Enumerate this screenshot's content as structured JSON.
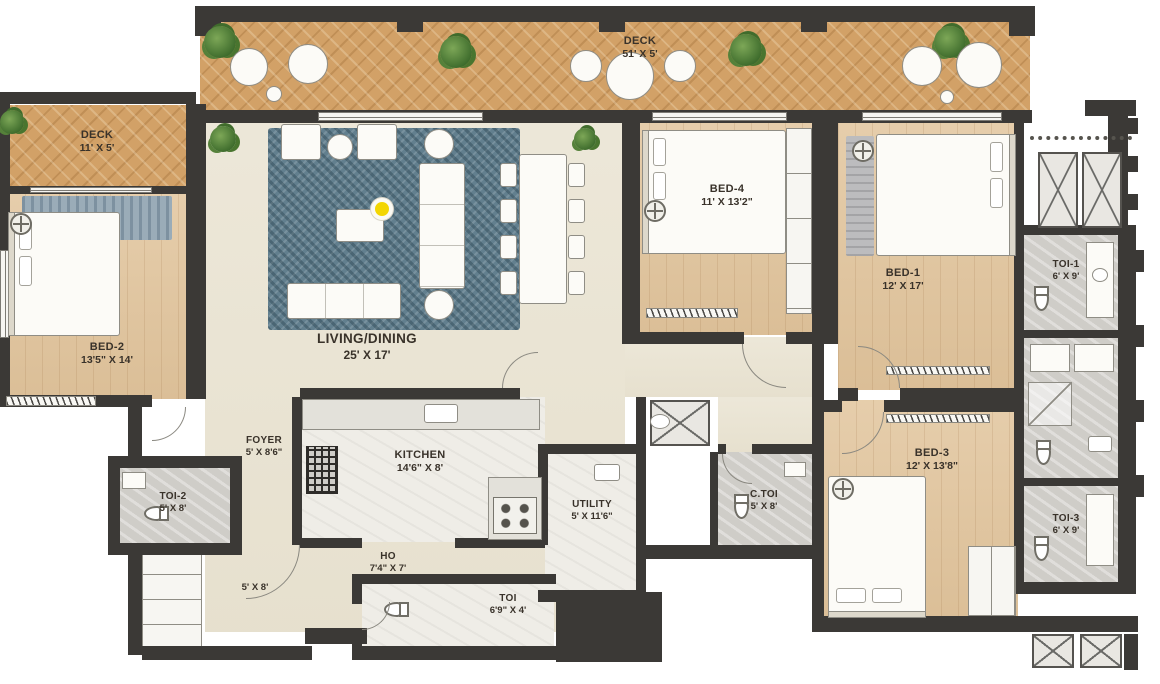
{
  "meta": {
    "type": "apartment-floor-plan"
  },
  "colors": {
    "wall": "#3b3936",
    "deck_wood": "#d2a167",
    "bedroom_wood": "#e3c8a2",
    "living_floor": "#eae4d3",
    "toilet_gray": "#cfcdc8",
    "rug_blue": "#627f8e",
    "accent_yellow": "#f3d602",
    "plant_green": "#49752f"
  },
  "icons": {
    "ceiling_fan": "circle-with-cross",
    "plant": "green-foliage-blob",
    "wc": "toilet-pan-with-cistern",
    "lamp": "yellow-dot-white-ring",
    "duct": "x-hatched-shaft",
    "door": "quarter-circle-swing-arc"
  },
  "rooms": {
    "deck_main": {
      "name": "DECK",
      "dims": "51' X 5'"
    },
    "deck_left": {
      "name": "DECK",
      "dims": "11' X 5'"
    },
    "bed2": {
      "name": "BED-2",
      "dims": "13'5\" X 14'"
    },
    "living": {
      "name": "LIVING/DINING",
      "dims": "25' X 17'"
    },
    "bed4": {
      "name": "BED-4",
      "dims": "11' X 13'2\""
    },
    "bed1": {
      "name": "BED-1",
      "dims": "12' X 17'"
    },
    "toi1": {
      "name": "TOI-1",
      "dims": "6' X 9'"
    },
    "foyer": {
      "name": "FOYER",
      "dims": "5' X 8'6\""
    },
    "kitchen": {
      "name": "KITCHEN",
      "dims": "14'6\" X 8'"
    },
    "toi2": {
      "name": "TOI-2",
      "dims": "5' X 8'"
    },
    "utility": {
      "name": "UTILITY",
      "dims": "5' X 11'6\""
    },
    "ctoi": {
      "name": "C.TOI",
      "dims": "5' X 8'"
    },
    "bed3": {
      "name": "BED-3",
      "dims": "12' X 13'8\""
    },
    "toi3": {
      "name": "TOI-3",
      "dims": "6' X 9'"
    },
    "ho": {
      "name": "HO",
      "dims": "7'4\" X 7'"
    },
    "passage": {
      "name": "",
      "dims": "5' X 8'"
    },
    "toi_powder": {
      "name": "TOI",
      "dims": "6'9\" X 4'"
    }
  }
}
